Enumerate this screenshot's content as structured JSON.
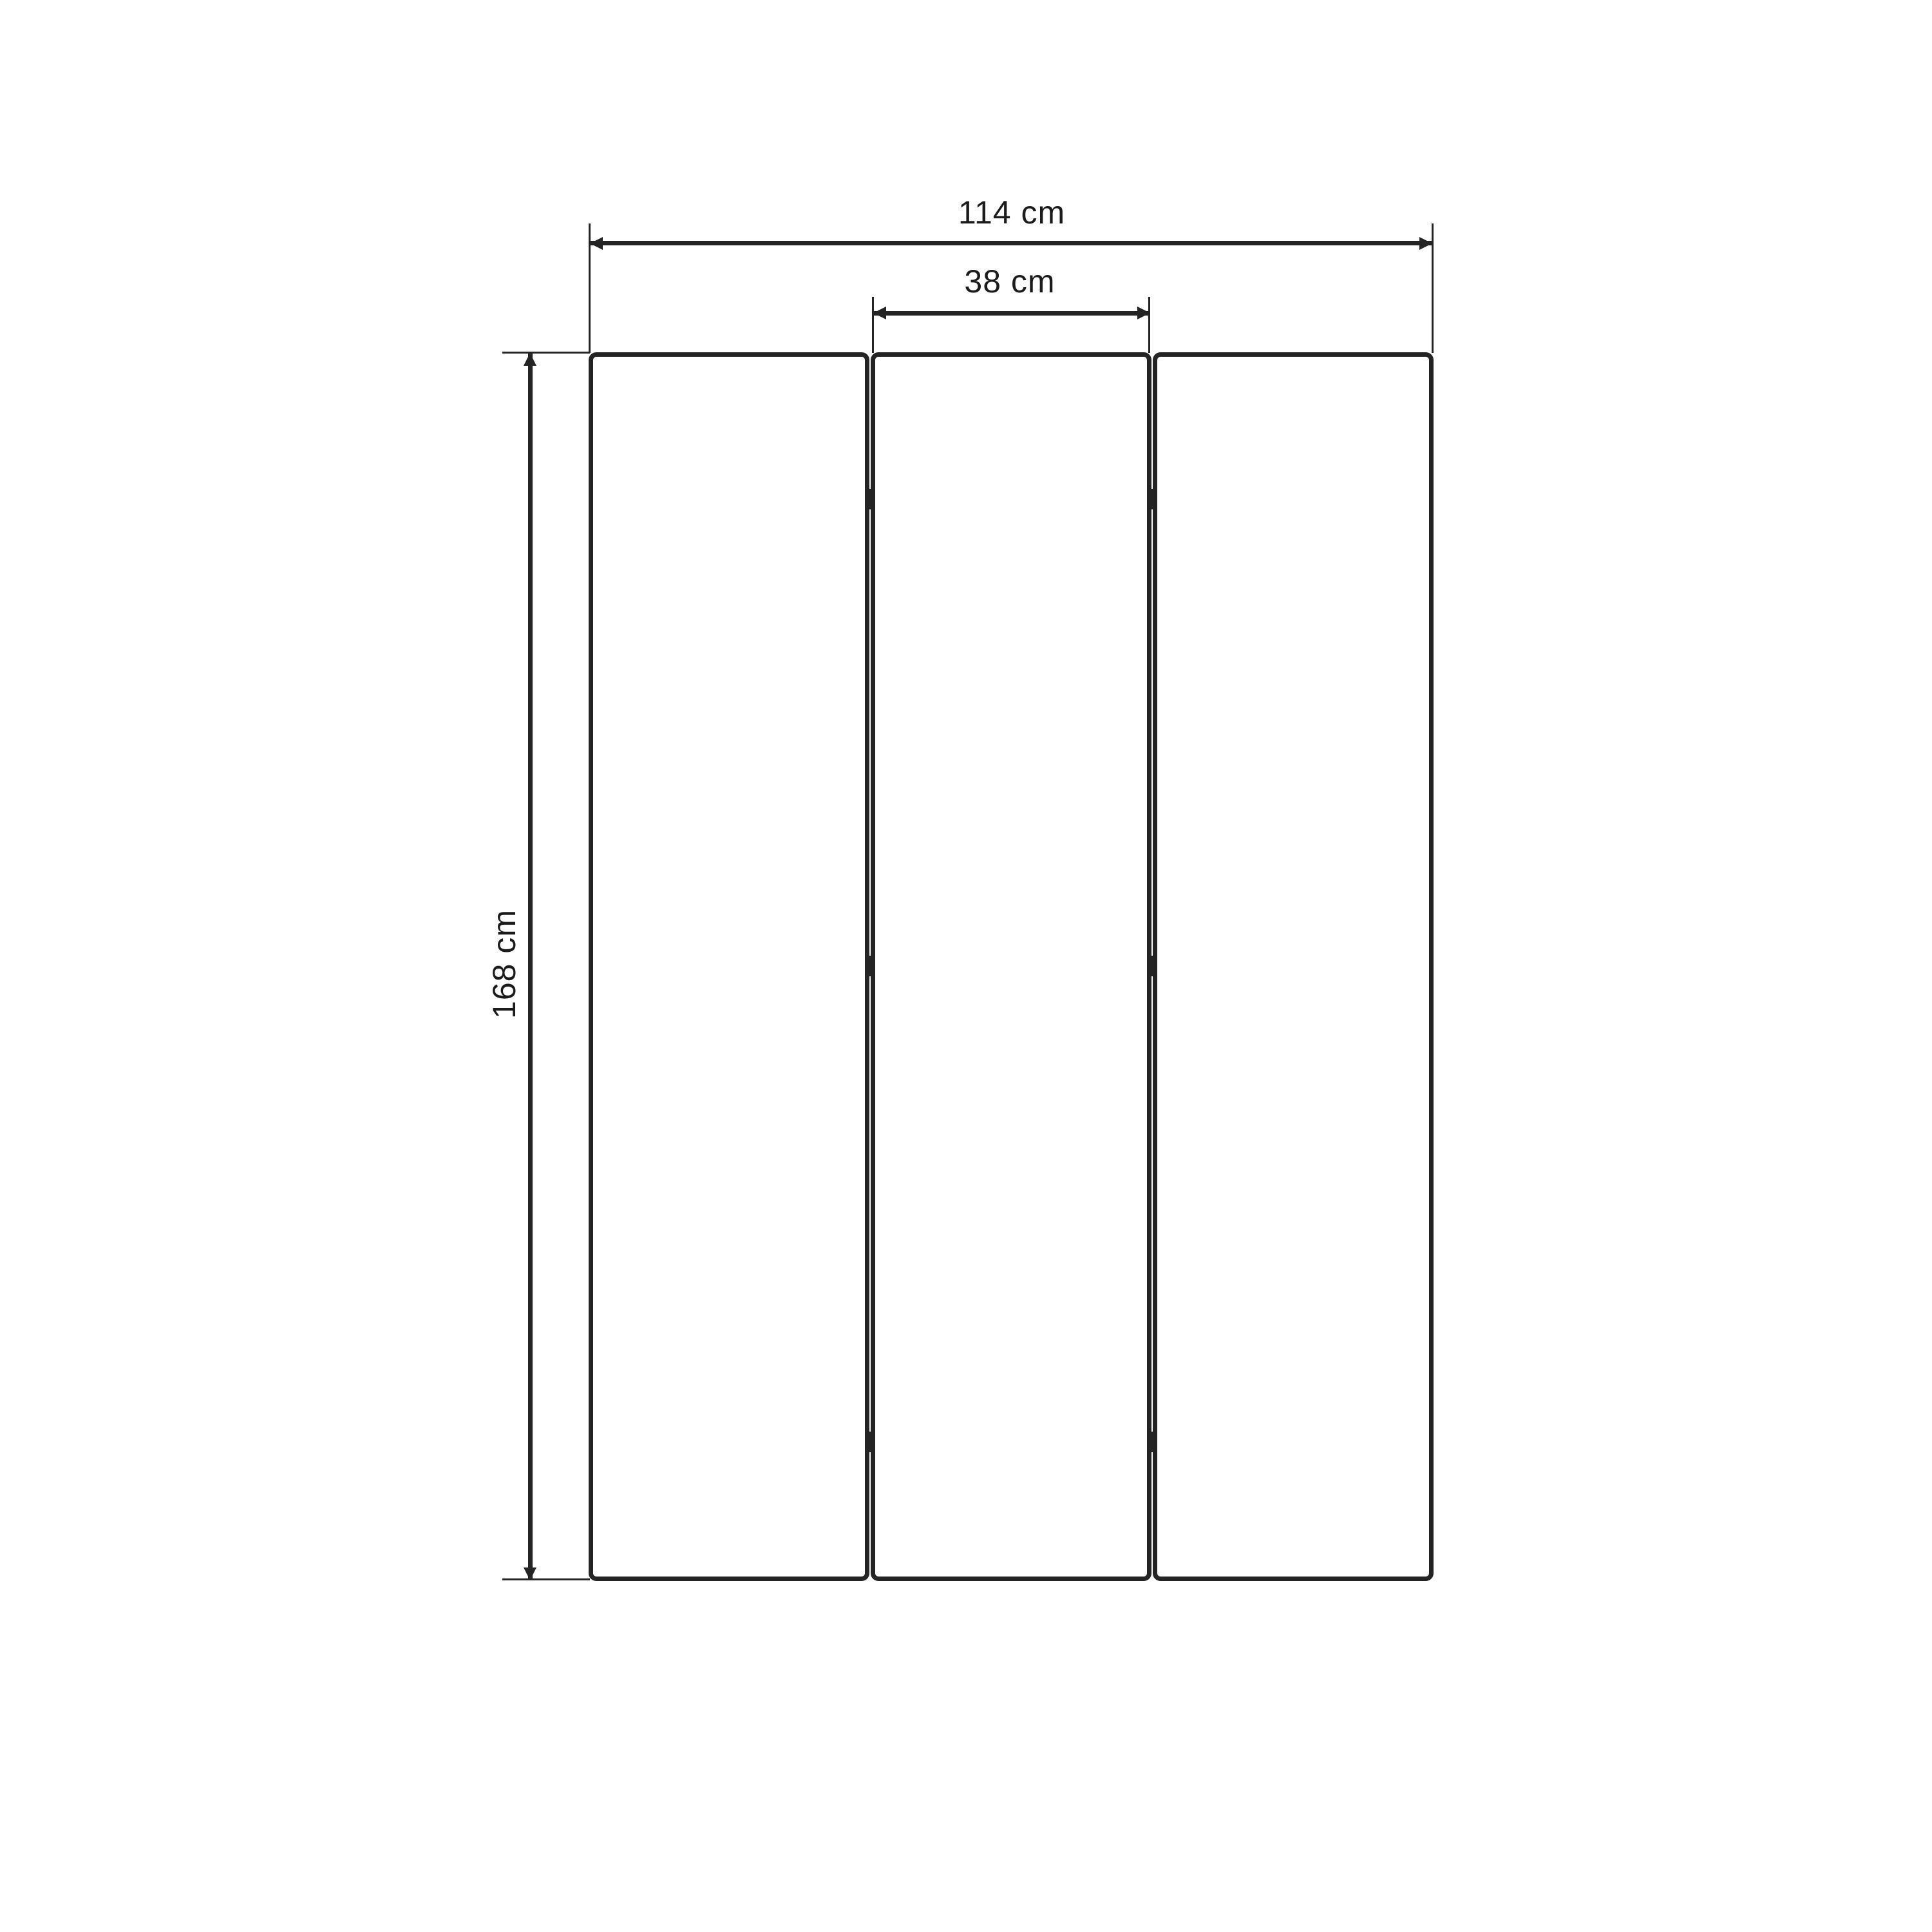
{
  "drawing": {
    "unit": "cm",
    "background_color": "#ffffff",
    "line_color": "#242424",
    "text_color": "#1b1b1b",
    "panel_count": 3,
    "hinges_per_gap": 3,
    "dimensions": {
      "overall_width": {
        "value": 114,
        "unit": "cm",
        "label": "114 cm"
      },
      "panel_width": {
        "value": 38,
        "unit": "cm",
        "label": "38 cm"
      },
      "overall_height": {
        "value": 168,
        "unit": "cm",
        "label": "168 cm"
      }
    }
  }
}
